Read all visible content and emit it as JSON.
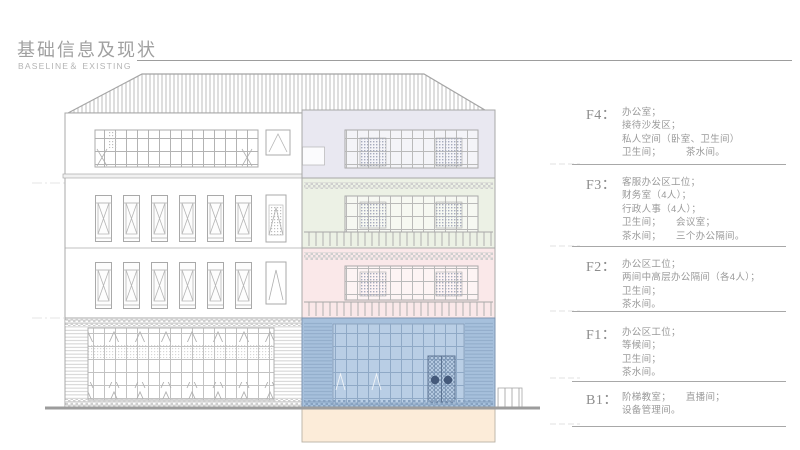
{
  "header": {
    "title": "基础信息及现状",
    "subtitle": "BASELINE＆ EXISTING"
  },
  "colors": {
    "f4_tint": "#e9e8f1",
    "f3_tint": "#ecf1e5",
    "f2_tint": "#fae8e9",
    "f1_tint": "#a6c0dc",
    "f1_glazing": "#b9cee5",
    "b1_tint": "#fcecd9",
    "door_handle": "#44597a",
    "line_art": "#a8a8a8"
  },
  "floors": [
    {
      "id": "f4",
      "label": "F4：",
      "lines": [
        "办公室；",
        "接待沙发区；",
        "私人空间（卧室、卫生间）",
        "卫生间；　　　茶水间。"
      ]
    },
    {
      "id": "f3",
      "label": "F3：",
      "lines": [
        "客服办公区工位；",
        "财务室（4人）；",
        "行政人事（4人）；",
        "卫生间；　　会议室；",
        "茶水间；　　三个办公隔间。"
      ]
    },
    {
      "id": "f2",
      "label": "F2：",
      "lines": [
        "办公区工位；",
        "两间中高层办公隔间（各4人）；",
        "卫生间；",
        "茶水间。"
      ]
    },
    {
      "id": "f1",
      "label": "F1：",
      "lines": [
        "办公区工位；",
        "等候间；",
        "卫生间；",
        "茶水间。"
      ]
    },
    {
      "id": "b1",
      "label": "B1：",
      "lines": [
        "阶梯教室；　　直播间；",
        "设备管理间。"
      ]
    }
  ]
}
